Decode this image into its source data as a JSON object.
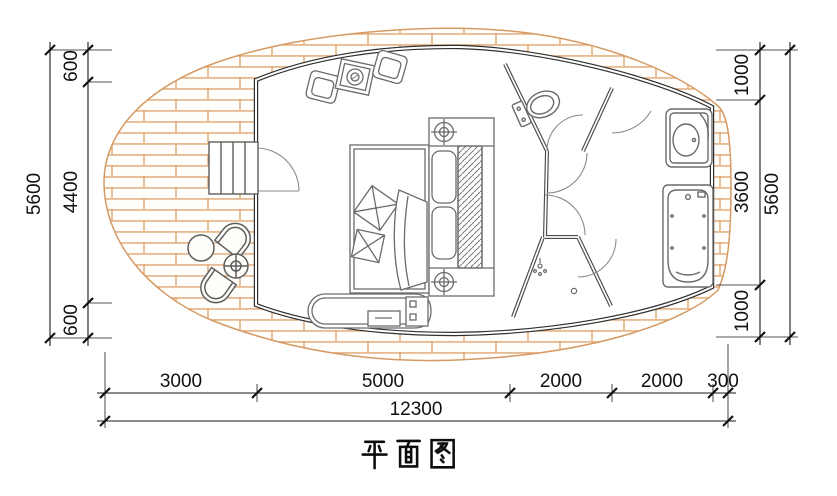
{
  "title": "平面图",
  "colors": {
    "deck_line": "#dfa571",
    "wall": "#2f2f2f",
    "partition": "#4a4a4a",
    "furniture_line": "#6b6b6b",
    "dimension_line": "#1a1a1a",
    "background": "#ffffff"
  },
  "dimensions": {
    "left_outer_total": "5600",
    "left_segments": [
      "600",
      "4400",
      "600"
    ],
    "right_segments": [
      "1000",
      "3600",
      "1000"
    ],
    "right_outer_total": "5600",
    "bottom_segments": [
      "3000",
      "5000",
      "2000",
      "2000",
      "300"
    ],
    "bottom_total": "12300"
  },
  "fixtures": [
    "wood-deck",
    "entry-stairs",
    "entry-door",
    "armchair",
    "side-table",
    "double-bed",
    "bedside-lamp",
    "wardrobe",
    "tv-cabinet",
    "toilet",
    "washbasin",
    "bathtub",
    "shower-head",
    "floor-drain",
    "outdoor-chair",
    "outdoor-round-table",
    "outdoor-side-table"
  ]
}
